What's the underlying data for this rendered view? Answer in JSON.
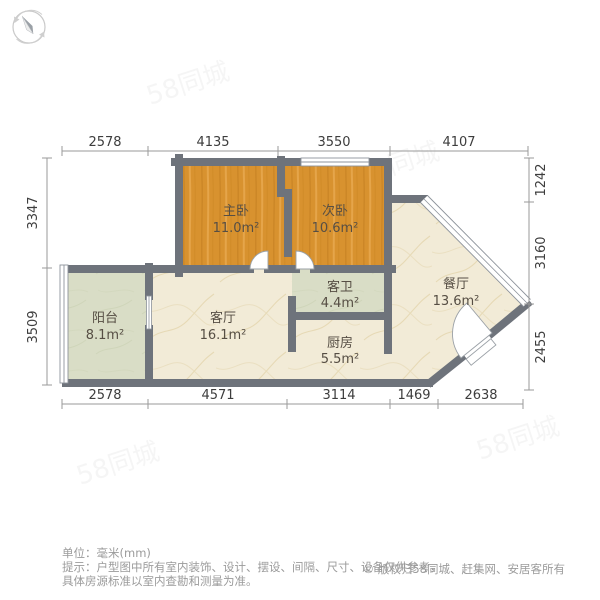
{
  "icons": {
    "compass": "compass-rose-north"
  },
  "colors": {
    "wall": "#6e737b",
    "wood_floor": "#d8922f",
    "tile_floor": "#f2ebd7",
    "green_floor": "#d9ddc6",
    "dim_text": "#3d3d3d",
    "footer_text": "#9b9b9b"
  },
  "rooms": [
    {
      "name": "主卧",
      "area": "11.0m²"
    },
    {
      "name": "次卧",
      "area": "10.6m²"
    },
    {
      "name": "客卫",
      "area": "4.4m²"
    },
    {
      "name": "厨房",
      "area": "5.5m²"
    },
    {
      "name": "阳台",
      "area": "8.1m²"
    },
    {
      "name": "客厅",
      "area": "16.1m²"
    },
    {
      "name": "餐厅",
      "area": "13.6m²"
    }
  ],
  "dimensions": {
    "top": [
      "2578",
      "4135",
      "3550",
      "4107"
    ],
    "bottom": [
      "2578",
      "4571",
      "3114",
      "1469",
      "2638"
    ],
    "left": [
      "3347",
      "3509"
    ],
    "right": [
      "1242",
      "3160",
      "2455"
    ]
  },
  "watermark": {
    "text": "58同城"
  },
  "footer": {
    "unit_label": "单位：毫米(mm)",
    "tip_line1": "提示：户型图中所有室内装饰、设计、摆设、间隔、尺寸、设备仅供参考，",
    "tip_line2": "具体房源标准以室内查勘和测量为准。",
    "copyright": "© 版权归58同城、赶集网、安居客所有"
  }
}
